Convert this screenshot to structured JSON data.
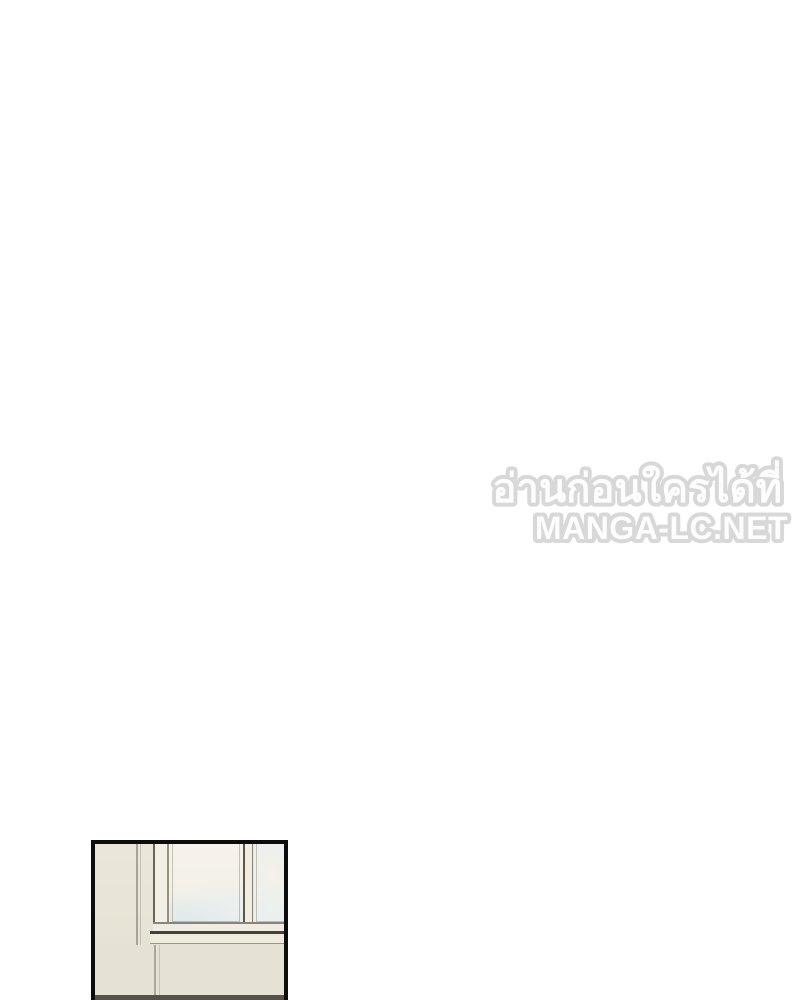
{
  "watermark": {
    "line1": "อ่านก่อนใครได้ที่",
    "line2": "MANGA-LC.NET",
    "text_color": "#fdfdfd",
    "outline_color": "#d8d8d8"
  },
  "panel": {
    "border_color": "#0d0d0d",
    "colors": {
      "wall": "#e8e4d7",
      "wall_below_sill": "#e5e1d4",
      "corner_line": "#a9a395",
      "window_frame": "#f2efe5",
      "frame_outline": "#5e5748",
      "sky_cream": "#f5f2e9",
      "sky_blue": "#e8eef1",
      "sill": "#edeade",
      "sill_line": "#45403a",
      "bottom_strip": "#55514b"
    }
  }
}
